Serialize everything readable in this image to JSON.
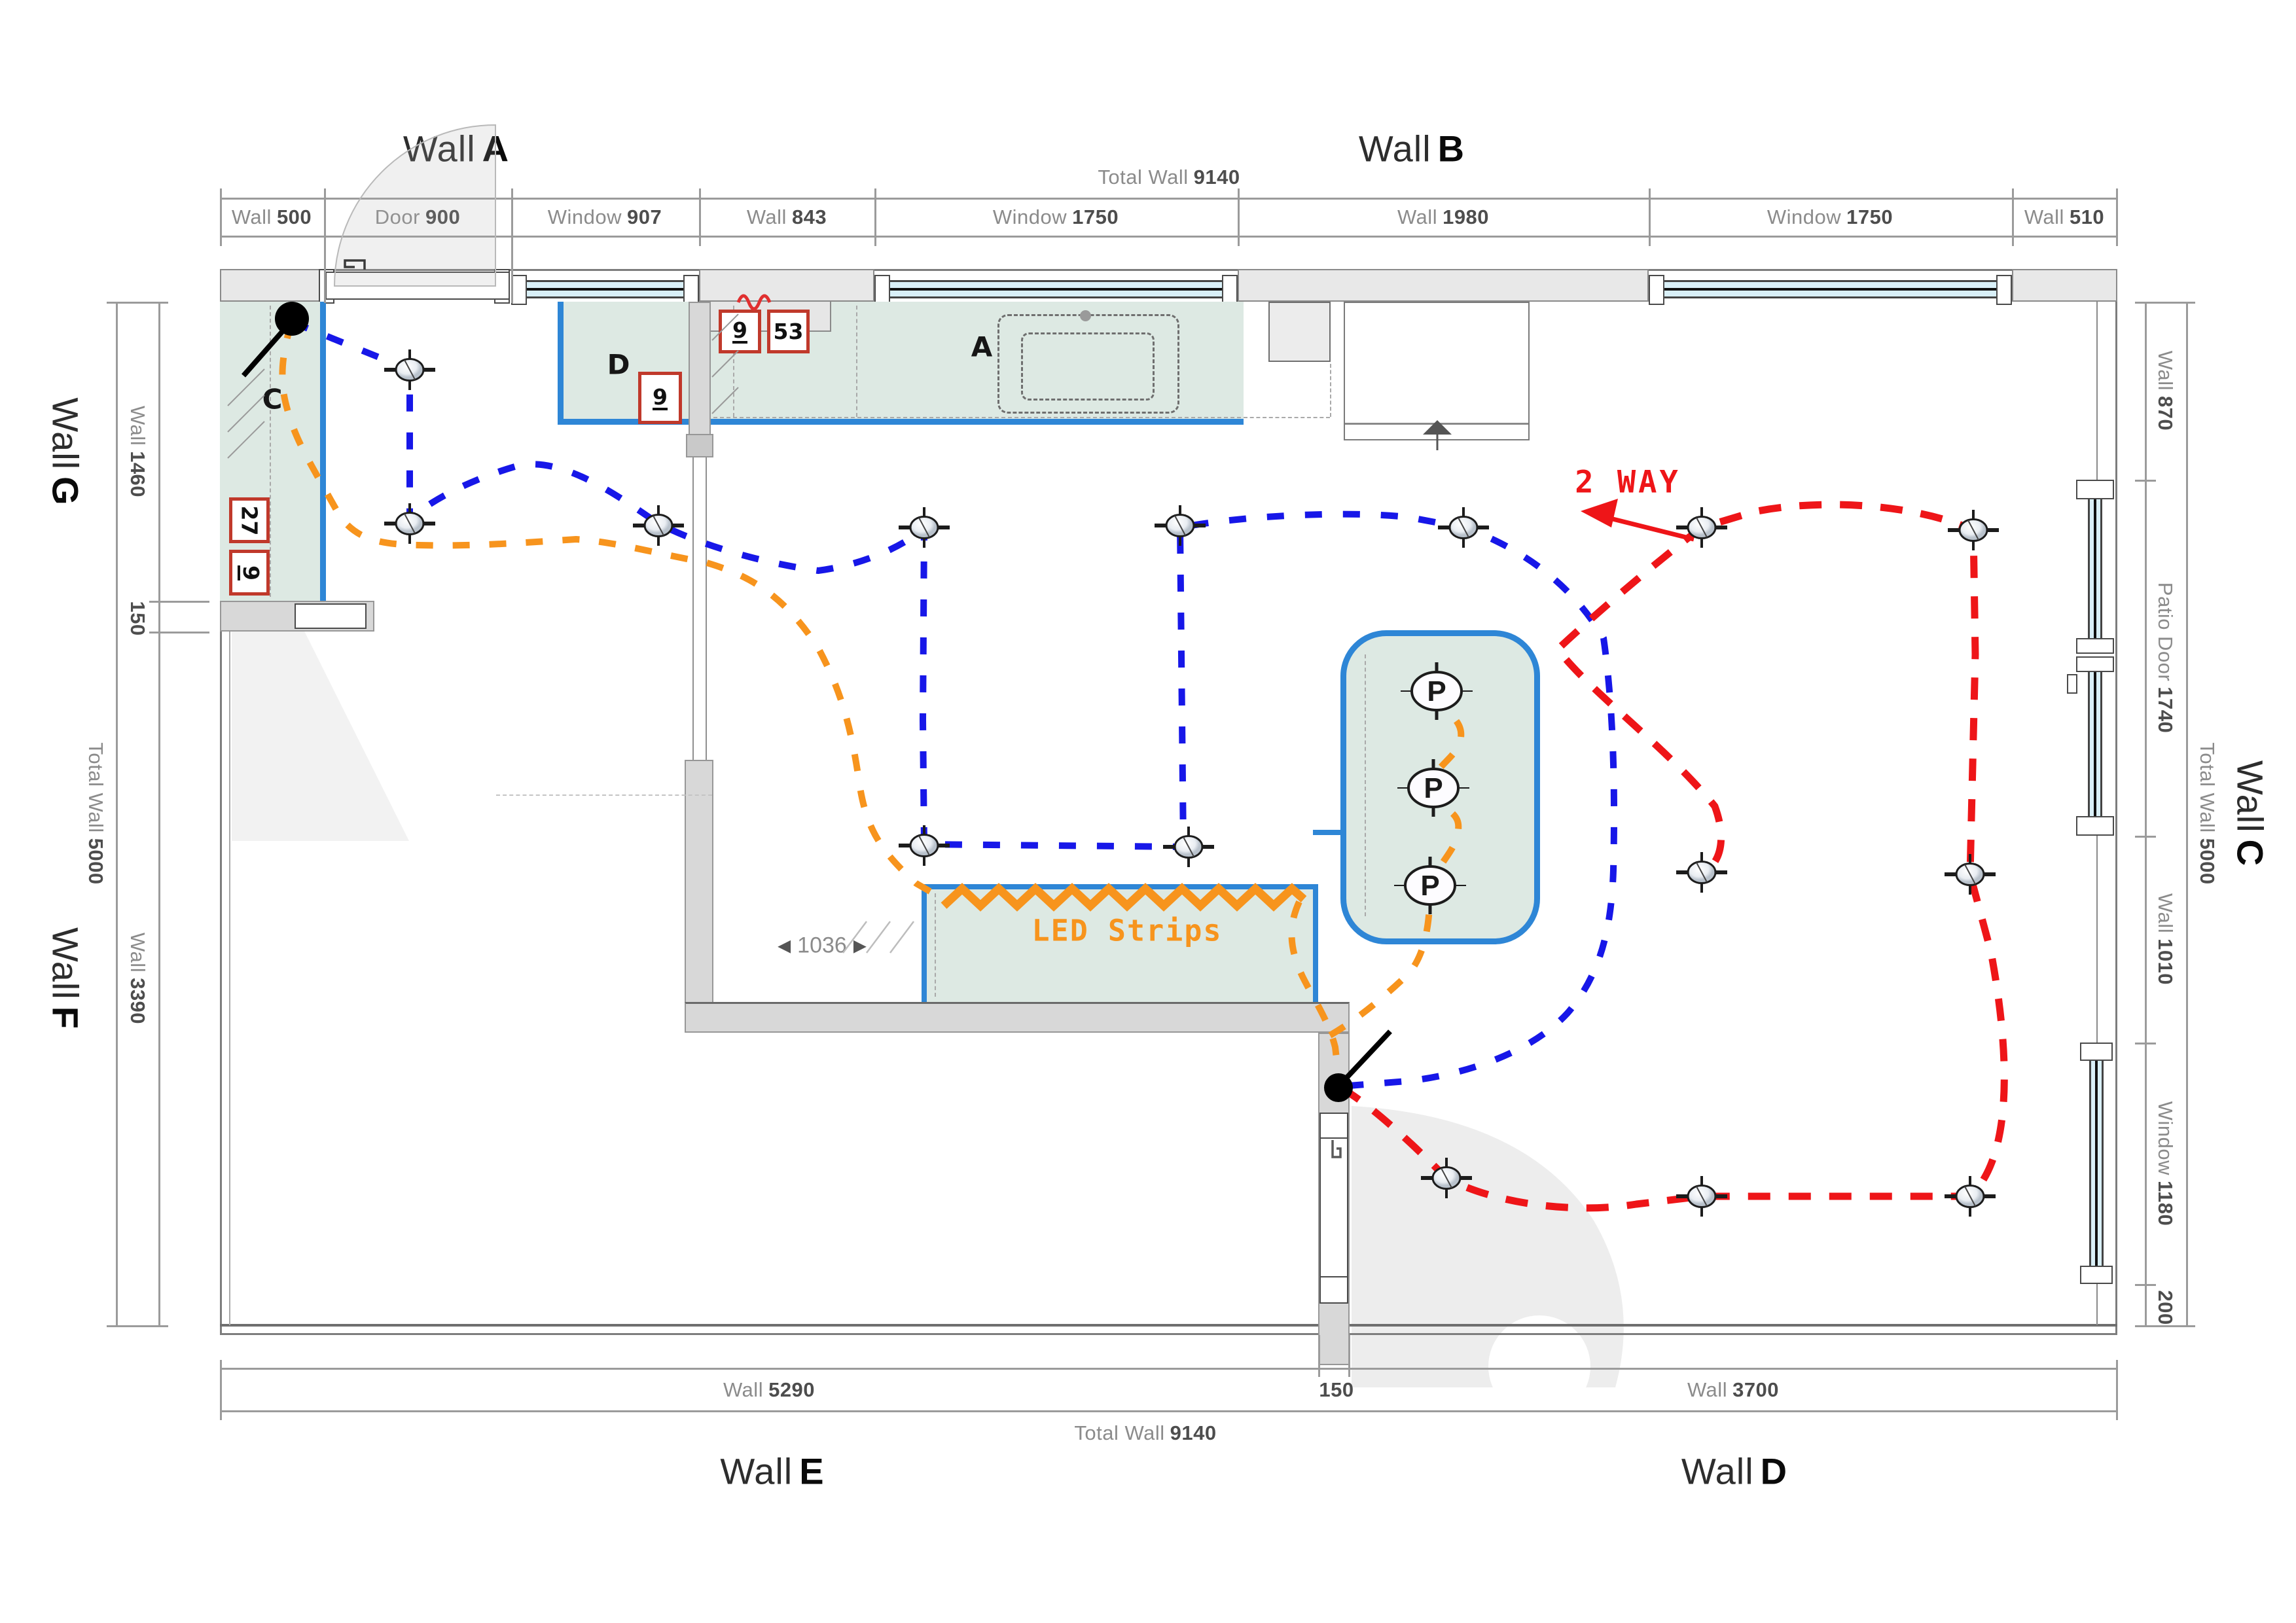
{
  "titles": {
    "a": {
      "prefix": "Wall",
      "letter": "A"
    },
    "b": {
      "prefix": "Wall",
      "letter": "B"
    },
    "c": {
      "prefix": "Wall",
      "letter": "C"
    },
    "d": {
      "prefix": "Wall",
      "letter": "D"
    },
    "e": {
      "prefix": "Wall",
      "letter": "E"
    },
    "f": {
      "prefix": "Wall",
      "letter": "F"
    },
    "g": {
      "prefix": "Wall",
      "letter": "G"
    }
  },
  "totals": {
    "top": {
      "label": "Total Wall",
      "value": "9140"
    },
    "bottom": {
      "label": "Total Wall",
      "value": "9140"
    },
    "left": {
      "label": "Total Wall",
      "value": "5000"
    },
    "right": {
      "label": "Total Wall",
      "value": "5000"
    }
  },
  "dims_top": [
    {
      "label": "Wall",
      "value": "500"
    },
    {
      "label": "Door",
      "value": "900"
    },
    {
      "label": "Window",
      "value": "907"
    },
    {
      "label": "Wall",
      "value": "843"
    },
    {
      "label": "Window",
      "value": "1750"
    },
    {
      "label": "Wall",
      "value": "1980"
    },
    {
      "label": "Window",
      "value": "1750"
    },
    {
      "label": "Wall",
      "value": "510"
    }
  ],
  "dims_left": [
    {
      "label": "Wall",
      "value": "1460"
    },
    {
      "label": "",
      "value": "150"
    },
    {
      "label": "Wall",
      "value": "3390"
    }
  ],
  "dims_right": [
    {
      "label": "Wall",
      "value": "870"
    },
    {
      "label": "Patio Door",
      "value": "1740"
    },
    {
      "label": "Wall",
      "value": "1010"
    },
    {
      "label": "Window",
      "value": "1180"
    },
    {
      "label": "",
      "value": "200"
    }
  ],
  "dims_bottom": [
    {
      "label": "Wall",
      "value": "5290"
    },
    {
      "label": "",
      "value": "150"
    },
    {
      "label": "Wall",
      "value": "3700"
    }
  ],
  "annotations": {
    "two_way": "2 WAY",
    "led_strips": "LED Strips",
    "inner_width": "1036",
    "arrow_left": "◀",
    "arrow_right": "▶"
  },
  "areas": {
    "a": "A",
    "c": "C",
    "d": "D"
  },
  "tags": {
    "c_box_top": "27",
    "c_box_bottom": "9",
    "a_box_left": "9",
    "a_box_right": "53",
    "d_box": "9"
  },
  "pendant_letter": "P",
  "colors": {
    "counter_fill": "#dde9e3",
    "counter_edge": "#2e86d6",
    "ceiling_circuit_blue": "#1717e8",
    "pendant_led_circuit_orange": "#f7941d",
    "two_way_circuit_red": "#ee1518",
    "tag_border_red": "#c0392b"
  }
}
